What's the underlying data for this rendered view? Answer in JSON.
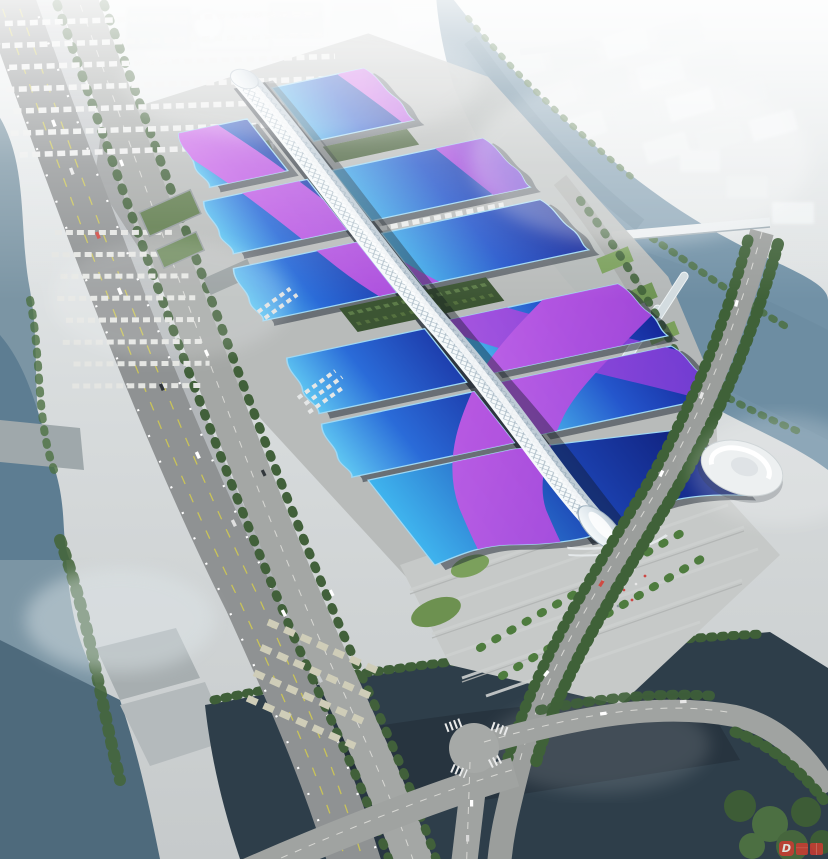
{
  "watermark": {
    "letter": "D"
  },
  "palette": {
    "roof_cyan": "#5ec6f2",
    "roof_blue": "#2a6bd8",
    "roof_navy": "#15289a",
    "ribbon_magenta": "#b44fe0",
    "ribbon_violet": "#7a3ed6",
    "spine_white": "#eef3f6",
    "water_river": "#7b95a4",
    "water_pond": "#2e3e4a",
    "road_gray": "#9b9e9c",
    "ground_gray": "#b7bab9",
    "tree_green": "#45663c",
    "lawn_green": "#6d9150",
    "fog_white": "#eef1f2",
    "people_red": "#cc4744",
    "watermark_red": "#d23a32"
  }
}
